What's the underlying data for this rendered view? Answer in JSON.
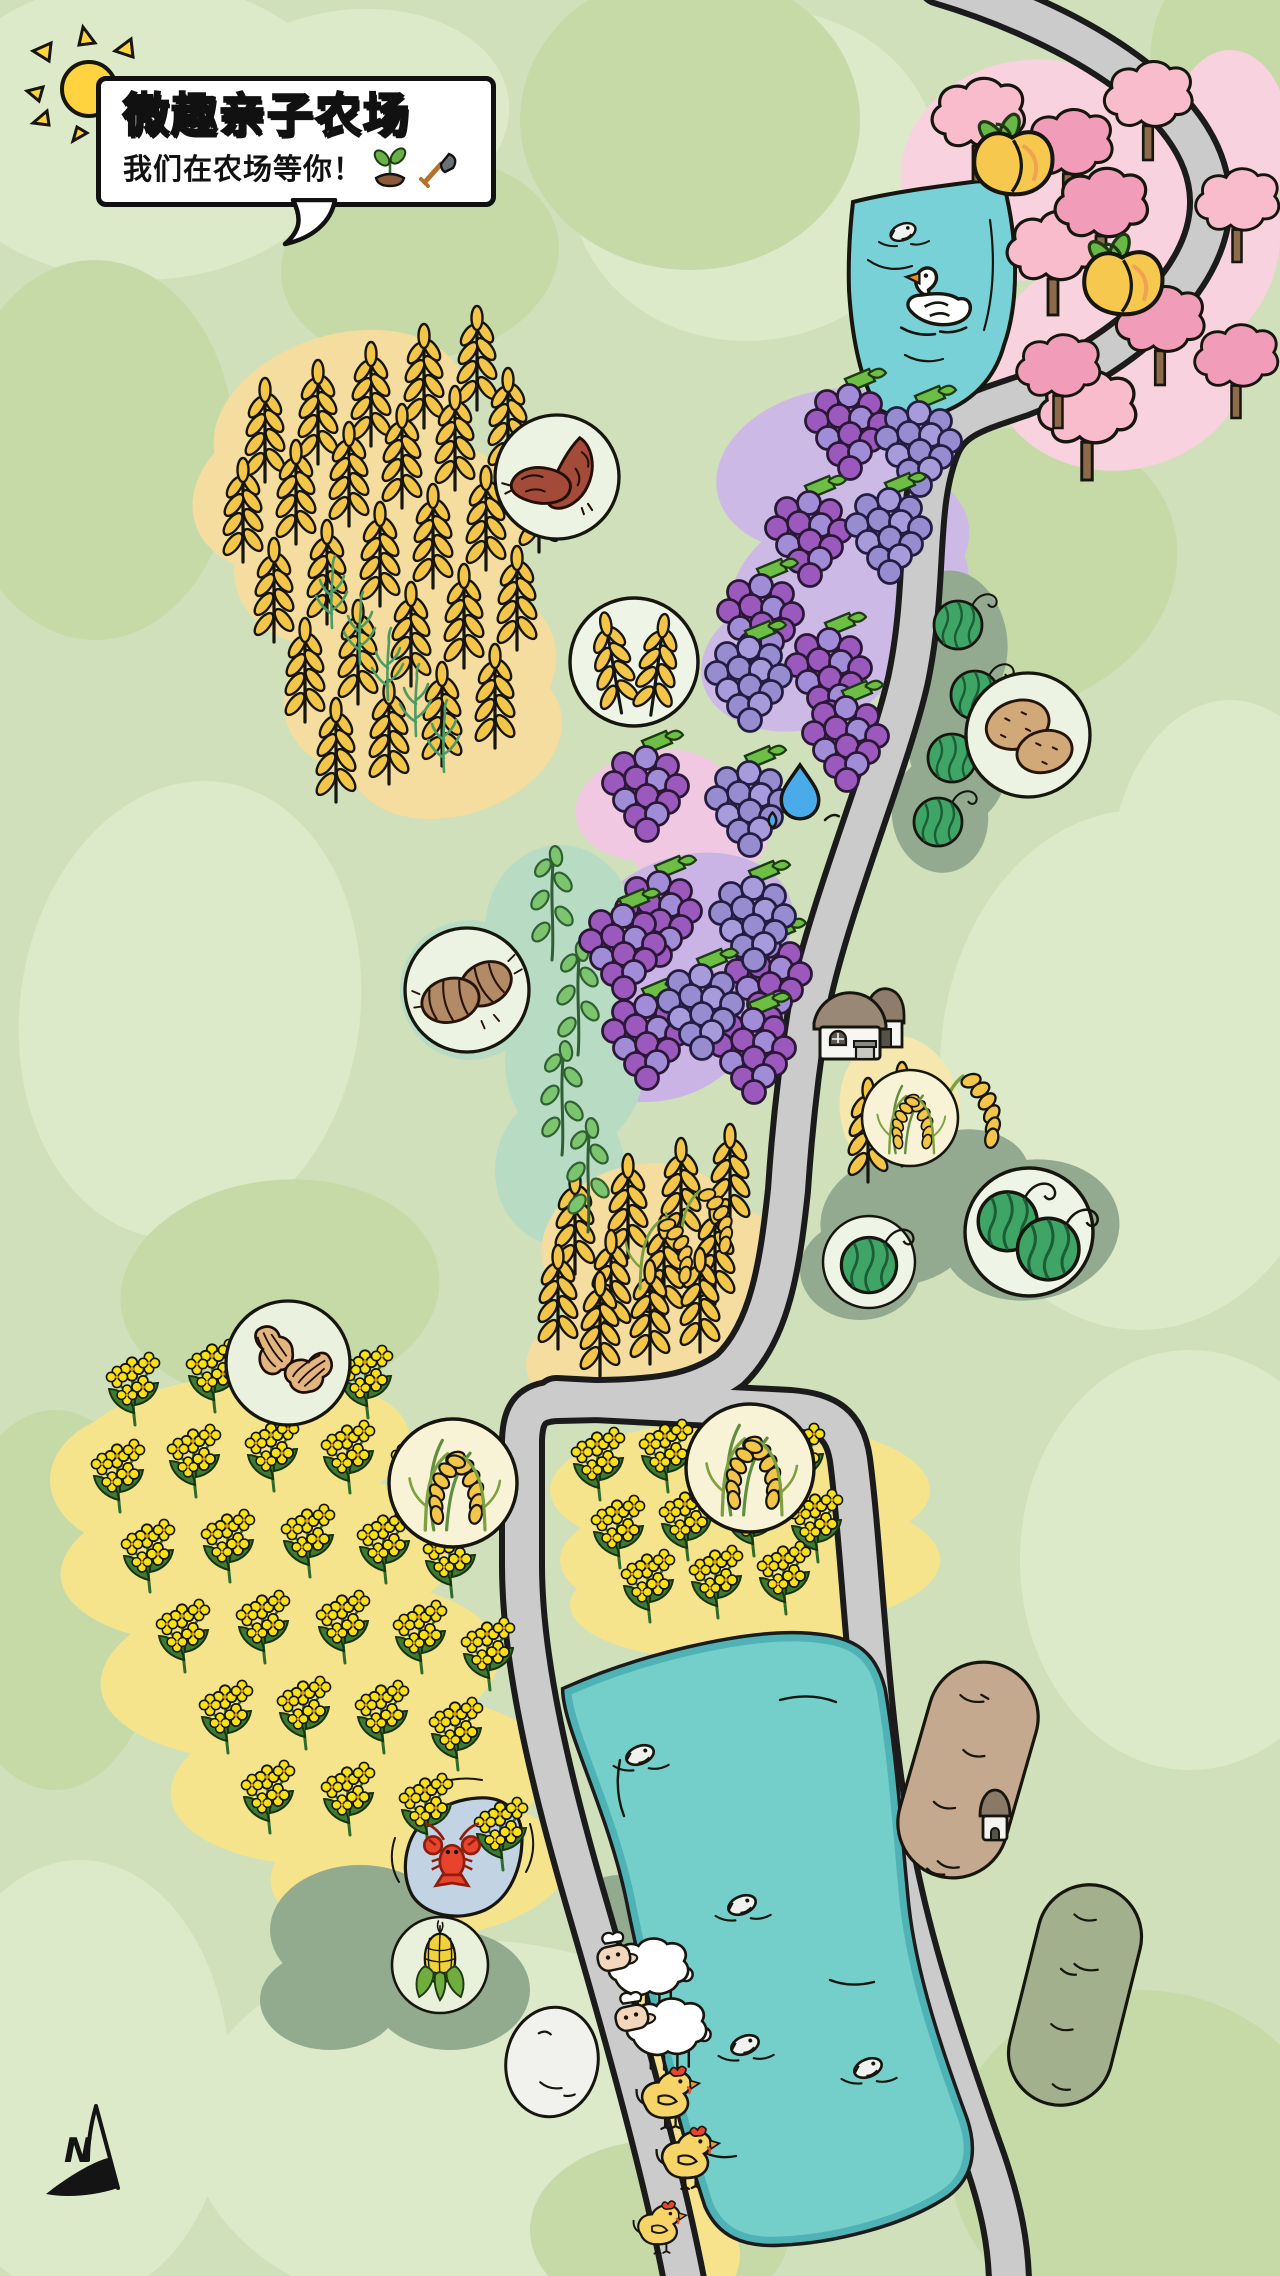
{
  "header": {
    "title": "微趣亲子农场",
    "subtitle": "我们在农场等你！"
  },
  "compass": {
    "label": "N"
  },
  "palette": {
    "background": "#cfe0ba",
    "patch_light": "#dceac9",
    "patch_medium": "#c6daa8",
    "road_fill": "#cbcbcb",
    "road_casing": "#1b1b1b",
    "water_teal": "#74cfca",
    "water_band": "#4fb3b6",
    "crab_pond_blue": "#c2d3e3",
    "field_yellow": "#f4dd9e",
    "rapeseed_yellow": "#f5e48c",
    "rapeseed_flower": "#f8e116",
    "grape_purple": "#9c59bd",
    "grape_light_purple": "#978cd0",
    "grape_blob": "#cdb9e6",
    "blossom_pink_light": "#f8bccd",
    "blossom_pink_deep": "#f19cb9",
    "blossom_blob": "#f8d2de",
    "melon_green": "#3ea566",
    "sage_blob": "#93aa90",
    "mint_blob": "#b7dcc3",
    "soil_tan": "#c4a98e",
    "soil_olive": "#a3b08d",
    "sun_yellow": "#ffd23f",
    "title_green": "#8cc63f",
    "wheat_gold": "#f3c64a",
    "chicken_yellow": "#f7d468",
    "crayfish_red": "#e8432c"
  },
  "map": {
    "icons": [
      {
        "type": "wheat",
        "points": [
          [
            265,
            480
          ],
          [
            318,
            462
          ],
          [
            371,
            444
          ],
          [
            424,
            426
          ],
          [
            477,
            408
          ],
          [
            243,
            560
          ],
          [
            296,
            542
          ],
          [
            349,
            524
          ],
          [
            402,
            506
          ],
          [
            455,
            488
          ],
          [
            508,
            470
          ],
          [
            274,
            640
          ],
          [
            327,
            622
          ],
          [
            380,
            604
          ],
          [
            433,
            586
          ],
          [
            486,
            568
          ],
          [
            539,
            550
          ],
          [
            305,
            720
          ],
          [
            358,
            702
          ],
          [
            411,
            684
          ],
          [
            464,
            666
          ],
          [
            517,
            648
          ],
          [
            336,
            800
          ],
          [
            389,
            782
          ],
          [
            442,
            764
          ],
          [
            495,
            746
          ],
          [
            575,
            1272
          ],
          [
            628,
            1256
          ],
          [
            681,
            1240
          ],
          [
            730,
            1226
          ],
          [
            558,
            1347
          ],
          [
            611,
            1332
          ],
          [
            664,
            1317
          ],
          [
            715,
            1302
          ],
          [
            600,
            1374
          ],
          [
            650,
            1362
          ],
          [
            700,
            1350
          ],
          [
            868,
            1180
          ],
          [
            902,
            1164
          ]
        ]
      },
      {
        "type": "wheat-green",
        "points": [
          [
            332,
            628
          ],
          [
            360,
            664
          ],
          [
            388,
            700
          ],
          [
            416,
            736
          ],
          [
            444,
            772
          ]
        ]
      },
      {
        "type": "sprig",
        "points": [
          [
            552,
            960
          ],
          [
            578,
            1055
          ],
          [
            562,
            1155
          ],
          [
            588,
            1232
          ]
        ]
      },
      {
        "type": "rice",
        "points": [
          [
            940,
            1152,
            1.15
          ],
          [
            680,
            1257
          ],
          [
            640,
            1287
          ]
        ]
      },
      {
        "type": "grape-a",
        "points": [
          [
            848,
            438
          ],
          [
            808,
            545
          ],
          [
            760,
            628
          ],
          [
            828,
            682
          ],
          [
            645,
            800
          ],
          [
            658,
            925
          ],
          [
            622,
            958
          ],
          [
            768,
            988
          ],
          [
            645,
            1048
          ],
          [
            752,
            1062
          ],
          [
            845,
            750
          ]
        ]
      },
      {
        "type": "grape-b",
        "points": [
          [
            918,
            455
          ],
          [
            888,
            542
          ],
          [
            748,
            690
          ],
          [
            748,
            815
          ],
          [
            752,
            930
          ],
          [
            700,
            1018
          ]
        ]
      },
      {
        "type": "melon",
        "points": [
          [
            958,
            625
          ],
          [
            975,
            695
          ],
          [
            952,
            758
          ],
          [
            938,
            822
          ]
        ]
      },
      {
        "type": "tree-a",
        "points": [
          [
            978,
            182
          ],
          [
            1148,
            160,
            0.95
          ],
          [
            1237,
            262,
            0.9
          ],
          [
            1053,
            315
          ],
          [
            1087,
            480,
            1.05
          ]
        ]
      },
      {
        "type": "tree-b",
        "points": [
          [
            1068,
            208,
            0.95
          ],
          [
            1101,
            272
          ],
          [
            1160,
            385,
            0.95
          ],
          [
            1236,
            418,
            0.9
          ],
          [
            1058,
            428,
            0.9
          ]
        ]
      },
      {
        "type": "peach",
        "points": [
          [
            1012,
            170,
            1.35
          ],
          [
            1122,
            290,
            1.35
          ]
        ]
      },
      {
        "type": "flower",
        "points": [
          [
            135,
            1425
          ],
          [
            215,
            1412
          ],
          [
            295,
            1406
          ],
          [
            368,
            1418
          ],
          [
            120,
            1512
          ],
          [
            196,
            1497
          ],
          [
            274,
            1491
          ],
          [
            350,
            1493
          ],
          [
            420,
            1503
          ],
          [
            150,
            1592
          ],
          [
            230,
            1582
          ],
          [
            310,
            1577
          ],
          [
            386,
            1583
          ],
          [
            452,
            1597
          ],
          [
            185,
            1672
          ],
          [
            265,
            1663
          ],
          [
            345,
            1663
          ],
          [
            422,
            1673
          ],
          [
            490,
            1690
          ],
          [
            228,
            1753
          ],
          [
            306,
            1749
          ],
          [
            384,
            1753
          ],
          [
            458,
            1770
          ],
          [
            270,
            1833
          ],
          [
            350,
            1835
          ],
          [
            428,
            1846
          ],
          [
            503,
            1870
          ],
          [
            600,
            1500
          ],
          [
            668,
            1492
          ],
          [
            736,
            1488
          ],
          [
            800,
            1496
          ],
          [
            620,
            1568
          ],
          [
            688,
            1560
          ],
          [
            754,
            1556
          ],
          [
            818,
            1562
          ],
          [
            650,
            1622
          ],
          [
            718,
            1618
          ],
          [
            786,
            1614
          ]
        ]
      },
      {
        "type": "sheep",
        "points": [
          [
            648,
            1982,
            0.95
          ],
          [
            666,
            2042,
            0.95
          ]
        ]
      },
      {
        "type": "chicken",
        "points": [
          [
            668,
            2108,
            0.95
          ],
          [
            688,
            2168,
            0.95
          ],
          [
            660,
            2236,
            0.8
          ]
        ]
      },
      {
        "type": "fish",
        "points": [
          [
            903,
            232
          ],
          [
            640,
            1755,
            1.1
          ],
          [
            742,
            1905,
            1.1
          ],
          [
            745,
            2045,
            1.1
          ],
          [
            868,
            2068,
            1.1
          ]
        ]
      },
      {
        "type": "swan",
        "points": [
          [
            935,
            312,
            1.3
          ]
        ]
      },
      {
        "type": "crayfish",
        "points": [
          [
            452,
            1856,
            1.35
          ]
        ]
      },
      {
        "type": "drop",
        "points": [
          [
            800,
            795,
            1.25
          ]
        ]
      }
    ],
    "badges": [
      {
        "type": "sweet-potato",
        "x": 557,
        "y": 477,
        "r": 62
      },
      {
        "type": "wheat",
        "x": 634,
        "y": 662,
        "r": 64
      },
      {
        "type": "potato",
        "x": 1028,
        "y": 735,
        "r": 62
      },
      {
        "type": "taro",
        "x": 467,
        "y": 990,
        "r": 62
      },
      {
        "type": "rice",
        "x": 910,
        "y": 1118,
        "r": 48
      },
      {
        "type": "melon-small",
        "x": 869,
        "y": 1262,
        "r": 46
      },
      {
        "type": "melon-big",
        "x": 1029,
        "y": 1232,
        "r": 64
      },
      {
        "type": "peanut",
        "x": 288,
        "y": 1363,
        "r": 62
      },
      {
        "type": "rice",
        "x": 453,
        "y": 1483,
        "r": 64
      },
      {
        "type": "rice",
        "x": 750,
        "y": 1468,
        "r": 64
      },
      {
        "type": "corn",
        "x": 440,
        "y": 1965,
        "r": 48
      }
    ]
  }
}
